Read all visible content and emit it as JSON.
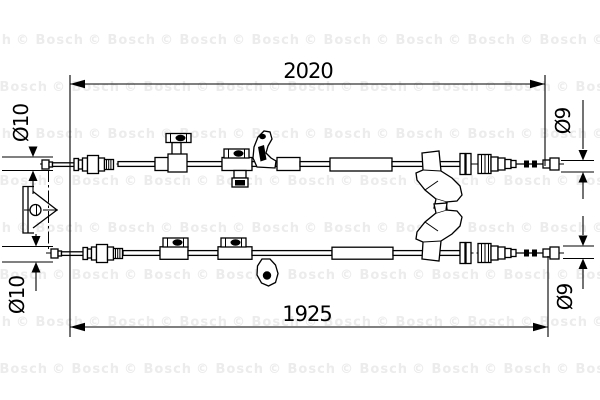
{
  "watermark": {
    "text": "© Bosch",
    "color": "#ececec"
  },
  "dimensions": {
    "top_length": "2020",
    "bottom_length": "1925",
    "top_left_diameter": "Ø10",
    "bottom_left_diameter": "Ø10",
    "top_right_diameter": "Ø9",
    "bottom_right_diameter": "Ø9"
  },
  "drawing": {
    "stroke_color": "#000000",
    "background": "#ffffff"
  }
}
